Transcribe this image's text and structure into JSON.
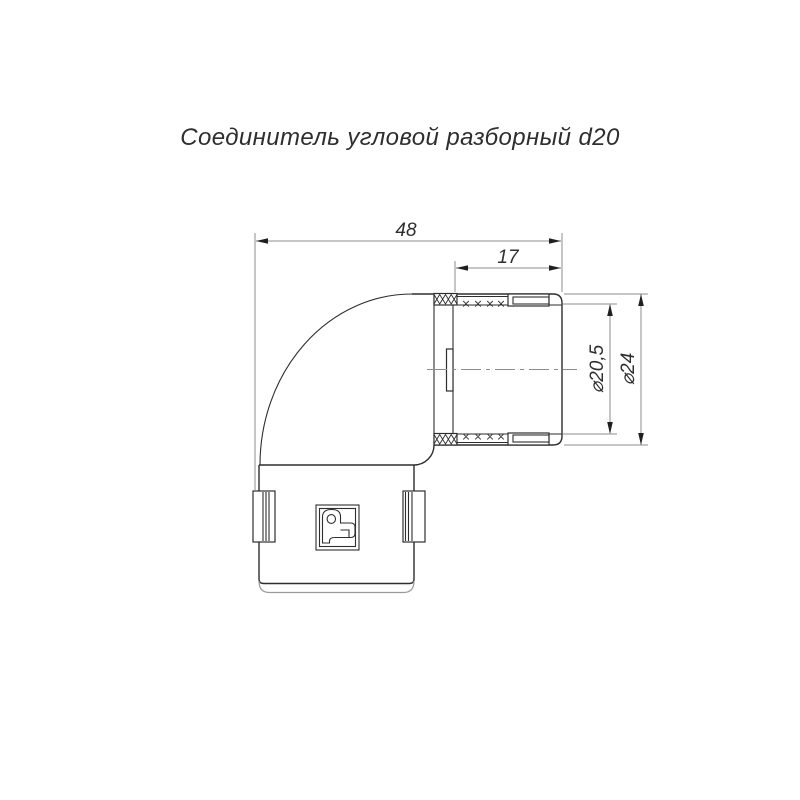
{
  "title": "Соединитель угловой разборный d20",
  "dimensions": {
    "total_length": "48",
    "spigot_length": "17",
    "inner_diameter": "⌀20,5",
    "outer_diameter": "⌀24"
  },
  "icons": {
    "brand_logo": "promrukav-p-monogram"
  },
  "colors": {
    "background": "#ffffff",
    "object_line": "#2e2e2e",
    "thin_line": "#8c8c8c",
    "text": "#2e2e2e"
  }
}
